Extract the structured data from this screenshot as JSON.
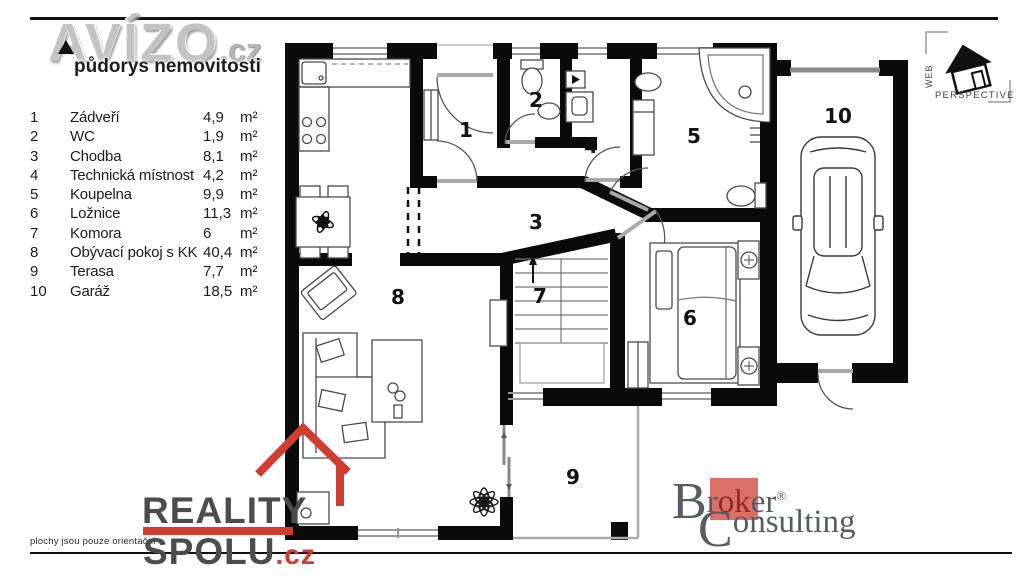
{
  "watermark": {
    "brand": "AVÍZO",
    "tld": ".cz",
    "subtitle": "půdorys nemovitosti"
  },
  "legend": {
    "rows": [
      {
        "num": "1",
        "name": "Zádveří",
        "area": "4,9",
        "unit": "m²"
      },
      {
        "num": "2",
        "name": "WC",
        "area": "1,9",
        "unit": "m²"
      },
      {
        "num": "3",
        "name": "Chodba",
        "area": "8,1",
        "unit": "m²"
      },
      {
        "num": "4",
        "name": "Technická místnost",
        "area": "4,2",
        "unit": "m²"
      },
      {
        "num": "5",
        "name": "Koupelna",
        "area": "9,9",
        "unit": "m²"
      },
      {
        "num": "6",
        "name": "Ložnice",
        "area": "11,3",
        "unit": "m²"
      },
      {
        "num": "7",
        "name": "Komora",
        "area": "6",
        "unit": "m²"
      },
      {
        "num": "8",
        "name": "Obývací pokoj s KK",
        "area": "40,4",
        "unit": "m²"
      },
      {
        "num": "9",
        "name": "Terasa",
        "area": "7,7",
        "unit": "m²"
      },
      {
        "num": "10",
        "name": "Garáž",
        "area": "18,5",
        "unit": "m²"
      }
    ]
  },
  "plan": {
    "labels": {
      "room1": "1",
      "room2": "2",
      "room3": "3",
      "room4": "4",
      "room5": "5",
      "room6": "6",
      "room7": "7",
      "room8": "8",
      "room9": "9",
      "room10": "10"
    }
  },
  "footer": {
    "note": "plochy jsou pouze orientační"
  },
  "reality_spolu": {
    "word1": "REALITY",
    "word2": "SPOLU",
    "tld": ".cz",
    "red": "#d13c31"
  },
  "broker": {
    "cap1": "B",
    "seg1": "r",
    "seg2": "ok",
    "seg3": "er",
    "reg": "®",
    "cap2": "C",
    "seg4": "onsulting",
    "salmon": "#db7066",
    "gray": "#575c63"
  },
  "web_perspective": {
    "vertical": "WEB",
    "word": "PERSPECTIVE"
  }
}
